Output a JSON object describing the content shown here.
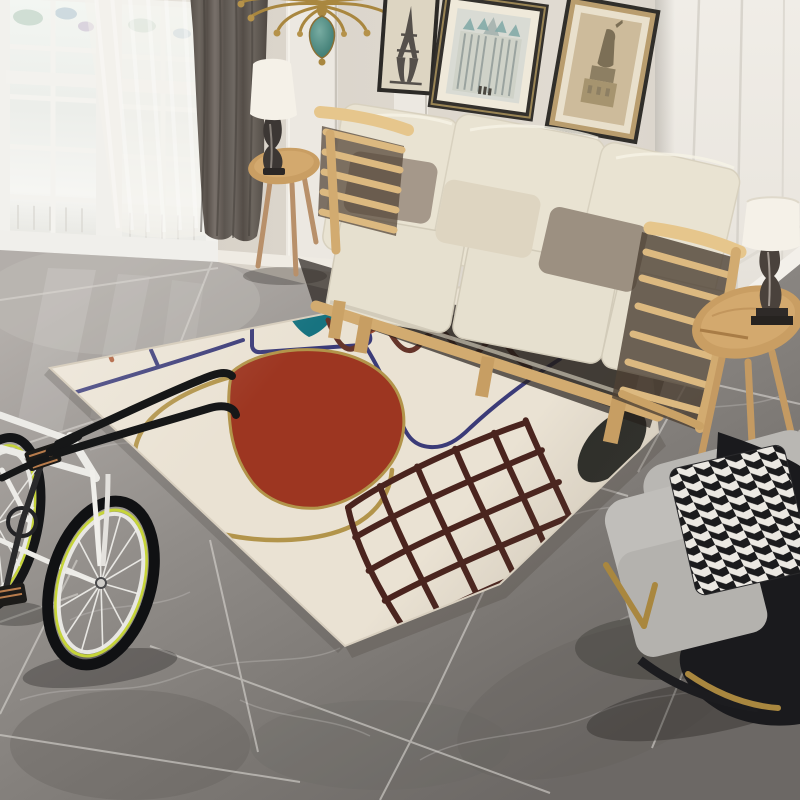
{
  "meta": {
    "title": "Living room product photo: cream abstract-art area rug with sofa, bicycle and armchair",
    "style": "photograph"
  },
  "palette": {
    "wall_beige": "#d9d3c9",
    "wall_white": "#edeae3",
    "window_frame": "#f2f1ed",
    "glass": "#eef1ee",
    "curtain_gray": "#665f58",
    "floor_gray": "#8f8b87",
    "grout": "#dad7d2",
    "rug_bg": "#eae2d3",
    "rug_red": "#9d3621",
    "rug_teal": "#177380",
    "rug_navy": "#3b3b78",
    "rug_rust": "#ad5b36",
    "rug_brown": "#66352a",
    "rug_gold": "#b2944a",
    "rug_grid": "#4a241e",
    "rug_black": "#2c2d29",
    "sofa_cream": "#e9e3d2",
    "pillow_gray": "#a5988a",
    "pillow_cream": "#ded5c1",
    "pillow_taupe": "#9c9081",
    "wood": "#dcb980",
    "wood_dark": "#d2ab70",
    "table_wood": "#c99e63",
    "chair_gray": "#b9b7b3",
    "chair_black": "#1a1a1d",
    "brass": "#a9873f",
    "lamp_shade": "#f5f1e8",
    "bike_white": "#ecebe7",
    "bike_black": "#161718",
    "bike_lime": "#c6d438"
  },
  "scene": {
    "window": {
      "label": "white french window with muntin grid",
      "doors": 2
    },
    "curtains": {
      "dark": "charcoal drape",
      "sheer": "white voile"
    },
    "chandelier": {
      "label": "brass chandelier with teal glass drop"
    },
    "wall_art": [
      {
        "label": "eiffel tower print"
      },
      {
        "label": "cathedral facade print"
      },
      {
        "label": "statue of liberty print"
      }
    ],
    "sofa": {
      "label": "blond-wood frame sofa",
      "back_cushions": 3,
      "seat_cushions": 3,
      "pillows": 3
    },
    "side_tables": [
      {
        "label": "round tray table with white shade lamp"
      },
      {
        "label": "round tripod tray table with glass column lamp"
      }
    ],
    "armchair": {
      "label": "gray lounge chair, black shell, brass legs, houndstooth pillow"
    },
    "bicycle": {
      "label": "white single-speed bike with lime rim stripe"
    },
    "rug": {
      "label": "cream abstract area rug",
      "motifs": [
        "terracotta comb line",
        "navy rounded panel outline",
        "teal fan shape",
        "rust hook curve",
        "red-rust blob outlined in gold",
        "large gold arch outline",
        "dark brown squiggle line",
        "navy angular line",
        "dark maroon hand-drawn grid",
        "black half-moon at rug edge"
      ]
    },
    "floor": {
      "label": "gray marble tile floor laid diagonally"
    }
  }
}
